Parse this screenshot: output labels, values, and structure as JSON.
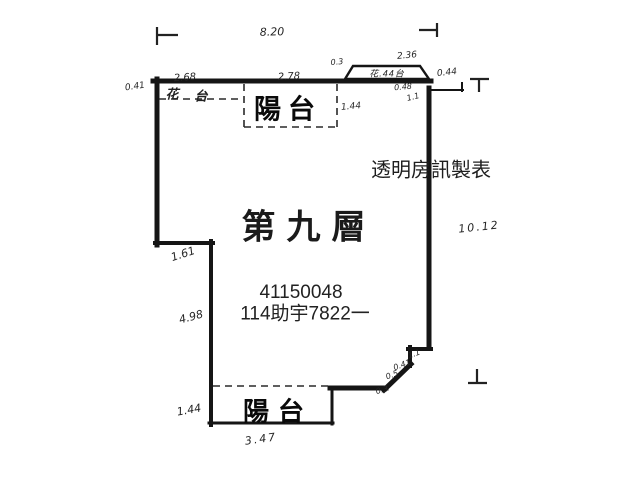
{
  "floor_plan": {
    "title": "第九層",
    "overlay": {
      "line1": "41150048",
      "line2": "114助宇7822一",
      "watermark": "透明房訊製表"
    },
    "labels": {
      "balcony_top": "陽台",
      "balcony_bottom": "陽台",
      "planter_strip_char1": "花",
      "planter_strip_char2": "台",
      "planter_box": "花.44台"
    },
    "dimensions": {
      "top_width": "8.20",
      "top_left_offset": "0.41",
      "top_seg_left": "2.68",
      "top_seg_mid": "2.78",
      "planter_left_offset": "0.3",
      "planter_width": "2.36",
      "planter_end": "0.44",
      "notch_width": "0.48",
      "notch_depth": "1.1",
      "balcony_top_depth": "1.44",
      "right_height": "10.12",
      "left_step_height": "1.61",
      "left_lower_height": "4.98",
      "corner_step1": "1.1",
      "corner_step2": "0.41",
      "corner_step3": "0.5",
      "corner_step4": "0.3",
      "balcony_bottom_depth": "1.44",
      "balcony_bottom_width": "3.47"
    },
    "ink_color": "#151515"
  }
}
